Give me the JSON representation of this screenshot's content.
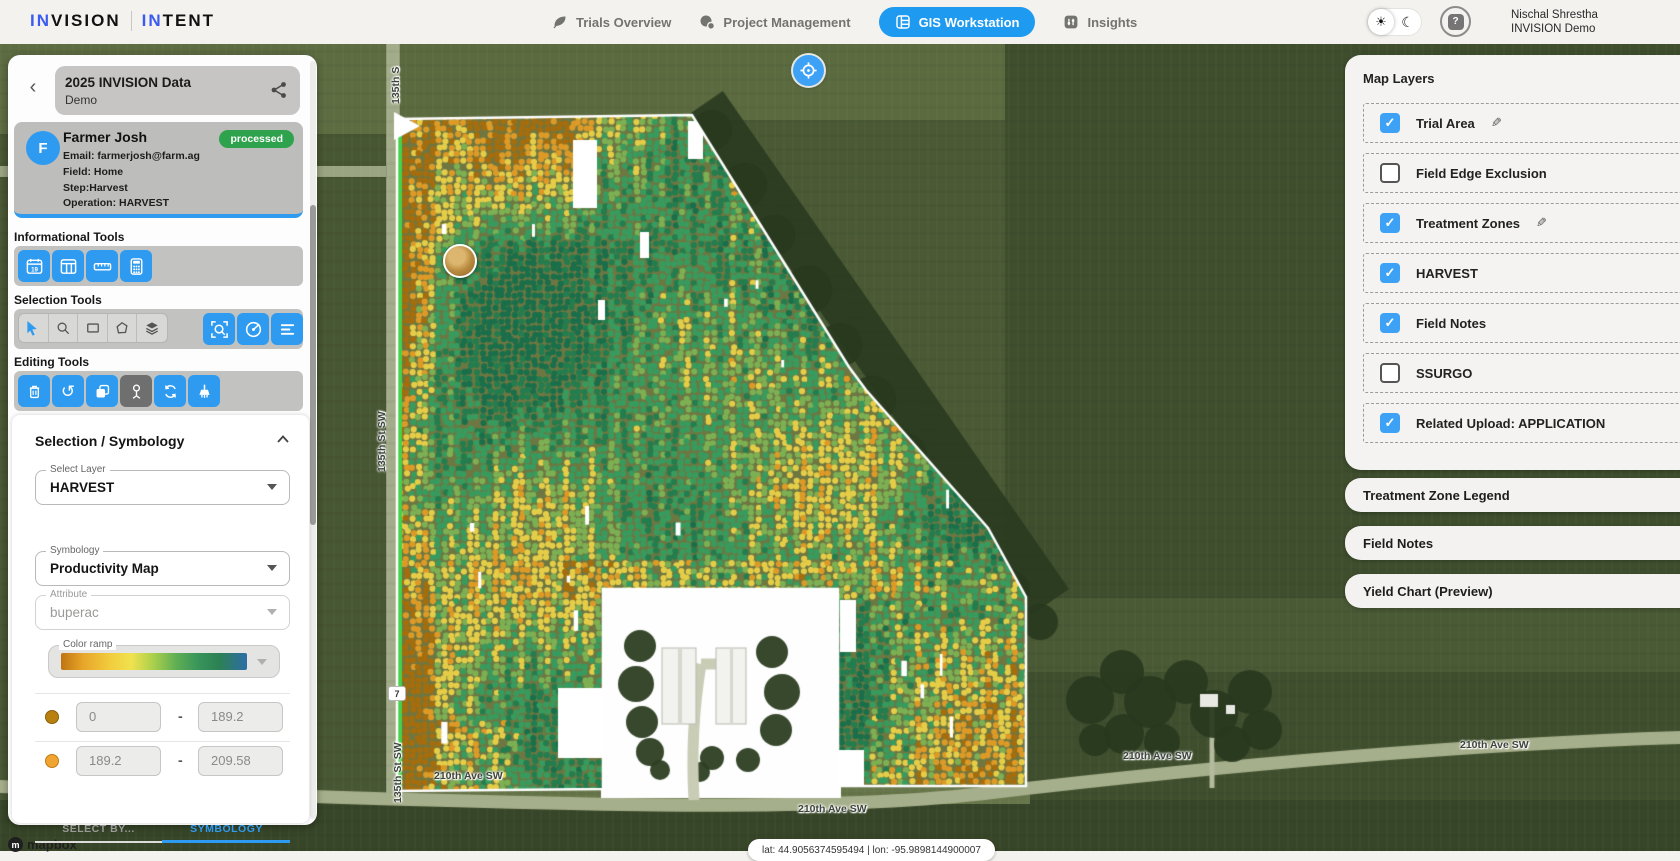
{
  "header": {
    "logo": {
      "invision_accent": "IN",
      "invision_rest": "VISION",
      "intent_accent": "IN",
      "intent_rest": "TENT"
    },
    "nav": [
      {
        "label": "Trials Overview",
        "icon": "leaf-icon",
        "active": false
      },
      {
        "label": "Project Management",
        "icon": "project-icon",
        "active": false
      },
      {
        "label": "GIS Workstation",
        "icon": "grid-icon",
        "active": true
      },
      {
        "label": "Insights",
        "icon": "insights-icon",
        "active": false
      }
    ],
    "theme_toggle": {
      "sun_icon": "☀",
      "moon_icon": "☾"
    },
    "help_glyph": "?",
    "user": {
      "name": "Nischal Shrestha",
      "org": "INVISION Demo"
    }
  },
  "sidebar": {
    "back_glyph": "‹",
    "trial": {
      "title": "2025 INVISION Data",
      "subtitle": "Demo"
    },
    "farmer": {
      "initial": "F",
      "name": "Farmer Josh",
      "status": "processed",
      "email": "Email: farmerjosh@farm.ag",
      "field": "Field: Home",
      "step": "Step:Harvest",
      "operation": "Operation: HARVEST"
    },
    "sections": {
      "informational": "Informational Tools",
      "selection": "Selection Tools",
      "editing": "Editing Tools"
    },
    "tools": {
      "informational": [
        "calendar-19-icon",
        "table-columns-icon",
        "ruler-icon",
        "calculator-icon"
      ],
      "selection_group": [
        "cursor-icon",
        "search-icon",
        "rectangle-select-icon",
        "polygon-select-icon",
        "layers-icon"
      ],
      "selection_actions": [
        "zoom-select-icon",
        "radius-select-icon",
        "list-select-icon"
      ],
      "editing": [
        "trash-icon",
        "undo-icon",
        "copy-icon",
        "vertex-tool-icon",
        "sync-icon",
        "brush-icon"
      ]
    },
    "symbology_panel": {
      "title": "Selection / Symbology",
      "select_layer_label": "Select Layer",
      "select_layer_value": "HARVEST",
      "tabs": [
        {
          "label": "SELECT BY...",
          "active": false
        },
        {
          "label": "SYMBOLOGY",
          "active": true
        }
      ],
      "symbology_label": "Symbology",
      "symbology_value": "Productivity Map",
      "attribute_label": "Attribute",
      "attribute_value": "buperac",
      "color_ramp_label": "Color ramp",
      "color_ramp_stops": [
        "#bf7410",
        "#e8a62a",
        "#f2ce3e",
        "#efe24e",
        "#a8cf4c",
        "#5fae54",
        "#37945a",
        "#2c8153",
        "#2d6da8"
      ],
      "range_separator": "-",
      "ranges": [
        {
          "dot_color": "#b8810f",
          "from": "0",
          "to": "189.2"
        },
        {
          "dot_color": "#f0a431",
          "from": "189.2",
          "to": "209.58"
        }
      ]
    }
  },
  "map": {
    "streets": {
      "st135_top": "135th S",
      "st135_mid": "135th St SW",
      "st135_bottom": "135th St SW",
      "ave210": "210th Ave SW",
      "highway_shield": "7"
    },
    "coordinates": "lat: 44.9056374595494 | lon: -95.9898144900007",
    "attribution": "mapbox",
    "dot_palette": [
      "#a56d0d",
      "#dd9a26",
      "#e5cd48",
      "#7cb053",
      "#389b5e",
      "#237d4e",
      "#1a6f4b"
    ]
  },
  "right_panel": {
    "map_layers_title": "Map Layers",
    "layers": [
      {
        "label": "Trial Area",
        "checked": true,
        "editable": true
      },
      {
        "label": "Field Edge Exclusion",
        "checked": false,
        "editable": false
      },
      {
        "label": "Treatment Zones",
        "checked": true,
        "editable": true
      },
      {
        "label": "HARVEST",
        "checked": true,
        "editable": false
      },
      {
        "label": "Field Notes",
        "checked": true,
        "editable": false
      },
      {
        "label": "SSURGO",
        "checked": false,
        "editable": false
      },
      {
        "label": "Related Upload: APPLICATION",
        "checked": true,
        "editable": false
      }
    ],
    "cards": [
      {
        "title": "Treatment Zone Legend"
      },
      {
        "title": "Field Notes"
      },
      {
        "title": "Yield Chart (Preview)"
      }
    ],
    "accent_color": "#2e9bf0",
    "checkbox_color": "#3da2f5"
  }
}
